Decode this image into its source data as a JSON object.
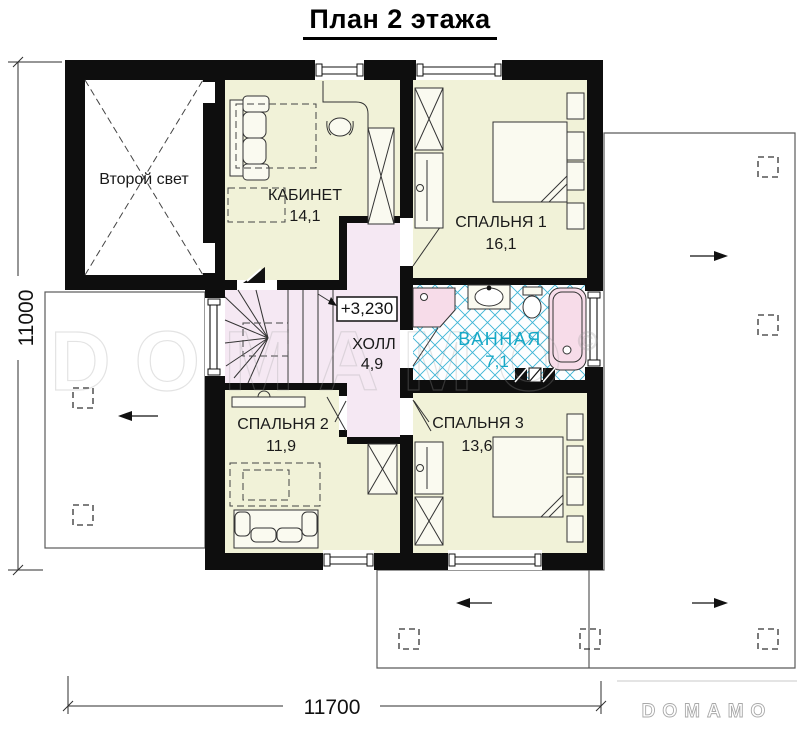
{
  "title": "План 2 этажа",
  "rooms": {
    "void": {
      "name": "Второй свет"
    },
    "office": {
      "name": "КАБИНЕТ",
      "area": "14,1"
    },
    "bedroom1": {
      "name": "СПАЛЬНЯ 1",
      "area": "16,1"
    },
    "hall": {
      "name": "ХОЛЛ",
      "area": "4,9"
    },
    "bathroom": {
      "name": "ВАННАЯ",
      "area": "7,1"
    },
    "bedroom2": {
      "name": "СПАЛЬНЯ 2",
      "area": "11,9"
    },
    "bedroom3": {
      "name": "СПАЛЬНЯ 3",
      "area": "13,6"
    }
  },
  "annotations": {
    "elevation": "+3,230"
  },
  "dimensions": {
    "width": "11700",
    "height": "11000"
  },
  "watermark": {
    "center": "DOMAMO",
    "copyright": "©",
    "logo": "DOMAMO"
  },
  "colors": {
    "wall": "#0e0e0e",
    "cream": "#f1f2d8",
    "pink": "#f5e8f3",
    "fixture": "#f7dce9",
    "tile": "#3cb4d6",
    "bathtext": "#16a8c6",
    "furn": "#fafaf0",
    "terrace": "#5a5a5a",
    "dim": "#2e2e2e",
    "wm": "#9e9e9e"
  }
}
